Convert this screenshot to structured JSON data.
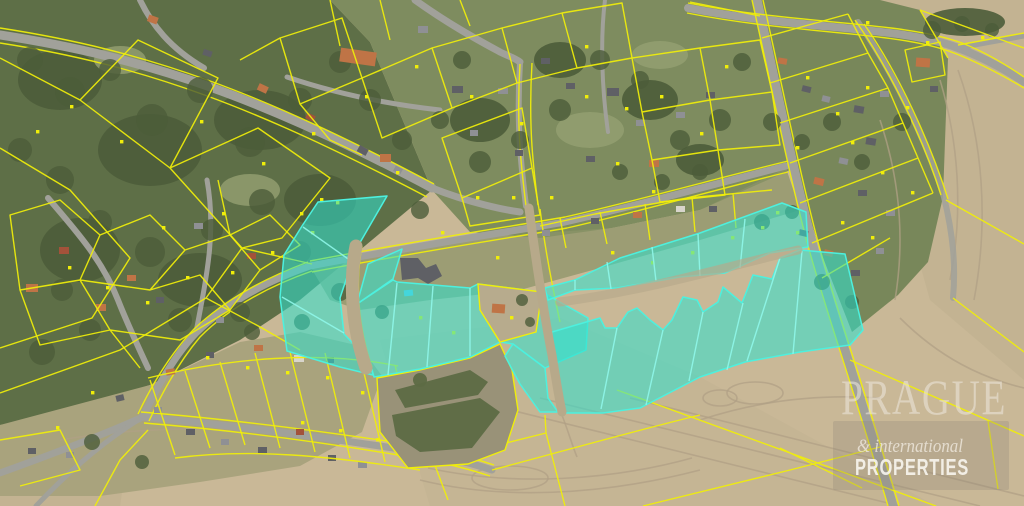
{
  "watermark": {
    "brand_top": "PRAGUE",
    "brand_mid": "& international",
    "brand_bottom": "PROPERTIES"
  },
  "colors": {
    "field": "#c9b897",
    "field_dark": "#beae8e",
    "forest": "#5e6f47",
    "forest_dark": "#4c5c3a",
    "village_green": "#7e8c5f",
    "village_light": "#95a072",
    "ground_village": "#a9a37d",
    "road": "#a1a19a",
    "dirt": "#b7a98a",
    "track": "#b0a085",
    "parcel_boundary": "#f0ee0a",
    "marker_red": "#e23c1e",
    "highlight_fill": "#2ee2d0",
    "highlight_edge": "#4df0de",
    "highlight_line": "#8ff6e9",
    "roof_orange": "#bf7446",
    "roof_red": "#a3523a",
    "roof_dark": "#5f6065",
    "roof_grey": "#8f9094",
    "roof_white": "#d8d5cc",
    "pool": "#5fc8e8",
    "scrub": "#999278",
    "scrub_dark": "#5d6c45",
    "wm_text": "#efe9df",
    "wm_panel": "#8d8478"
  },
  "icons": {
    "parcel_marker": "yellow-dot-icon",
    "highlight": "selected-parcels-overlay"
  }
}
